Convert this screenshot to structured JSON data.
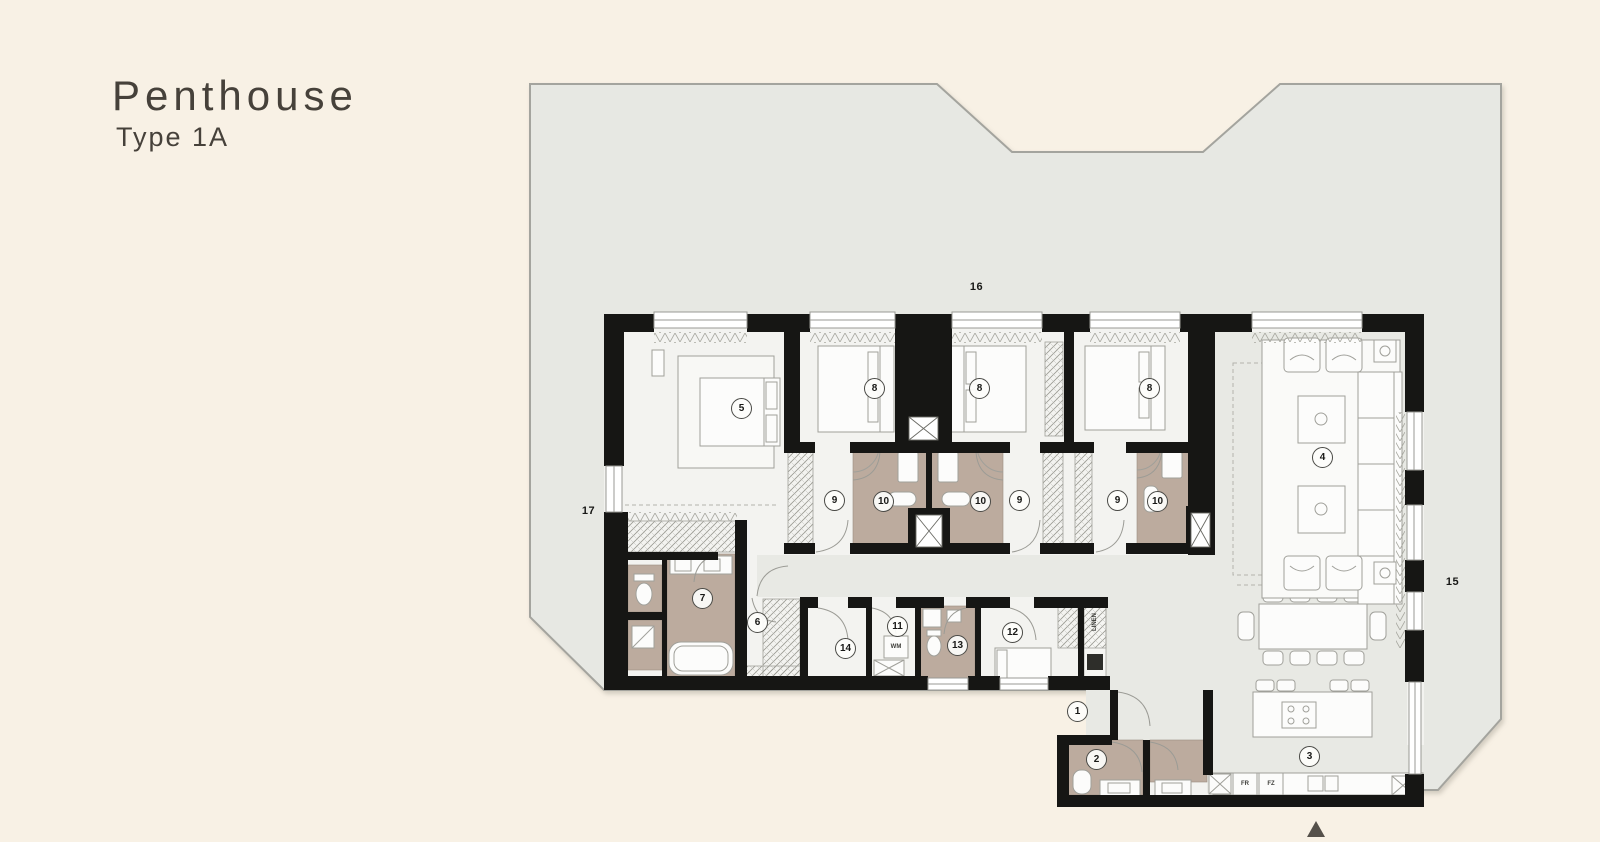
{
  "title": {
    "main": "Penthouse",
    "sub": "Type 1A"
  },
  "colors": {
    "background": "#f8f1e5",
    "terrace_floor": "#e7e8e3",
    "terrace_outline": "#a4a49e",
    "apartment_floor": "#f3f3f0",
    "open_area_floor": "#e8e9e4",
    "bathroom_tan": "#bcab9e",
    "walls": "#161614",
    "furniture_line": "#a0a09a"
  },
  "plan": {
    "room_labels": [
      {
        "num": "1",
        "x": 1077,
        "y": 711,
        "circled": true
      },
      {
        "num": "2",
        "x": 1096,
        "y": 759,
        "circled": true
      },
      {
        "num": "3",
        "x": 1309,
        "y": 756,
        "circled": true
      },
      {
        "num": "4",
        "x": 1322,
        "y": 457,
        "circled": true
      },
      {
        "num": "5",
        "x": 741,
        "y": 408,
        "circled": true
      },
      {
        "num": "6",
        "x": 757,
        "y": 622,
        "circled": true
      },
      {
        "num": "7",
        "x": 702,
        "y": 598,
        "circled": true
      },
      {
        "num": "8",
        "x": 874,
        "y": 388,
        "circled": true
      },
      {
        "num": "8",
        "x": 979,
        "y": 388,
        "circled": true
      },
      {
        "num": "8",
        "x": 1149,
        "y": 388,
        "circled": true
      },
      {
        "num": "9",
        "x": 834,
        "y": 500,
        "circled": true
      },
      {
        "num": "9",
        "x": 1019,
        "y": 500,
        "circled": true
      },
      {
        "num": "9",
        "x": 1117,
        "y": 500,
        "circled": true
      },
      {
        "num": "10",
        "x": 883,
        "y": 501,
        "circled": true
      },
      {
        "num": "10",
        "x": 980,
        "y": 501,
        "circled": true
      },
      {
        "num": "10",
        "x": 1157,
        "y": 501,
        "circled": true
      },
      {
        "num": "11",
        "x": 897,
        "y": 626,
        "circled": true
      },
      {
        "num": "12",
        "x": 1012,
        "y": 632,
        "circled": true
      },
      {
        "num": "13",
        "x": 957,
        "y": 645,
        "circled": true
      },
      {
        "num": "14",
        "x": 845,
        "y": 648,
        "circled": true
      },
      {
        "num": "15",
        "x": 1453,
        "y": 582,
        "circled": false
      },
      {
        "num": "16",
        "x": 977,
        "y": 287,
        "circled": false
      },
      {
        "num": "17",
        "x": 589,
        "y": 511,
        "circled": false
      }
    ],
    "fixture_labels": [
      {
        "text": "WM",
        "x": 896,
        "y": 647,
        "rotate": 0
      },
      {
        "text": "FR",
        "x": 1245,
        "y": 784,
        "rotate": 0
      },
      {
        "text": "FZ",
        "x": 1271,
        "y": 784,
        "rotate": 0
      },
      {
        "text": "LINEN",
        "x": 1095,
        "y": 622,
        "rotate": -90
      }
    ]
  }
}
